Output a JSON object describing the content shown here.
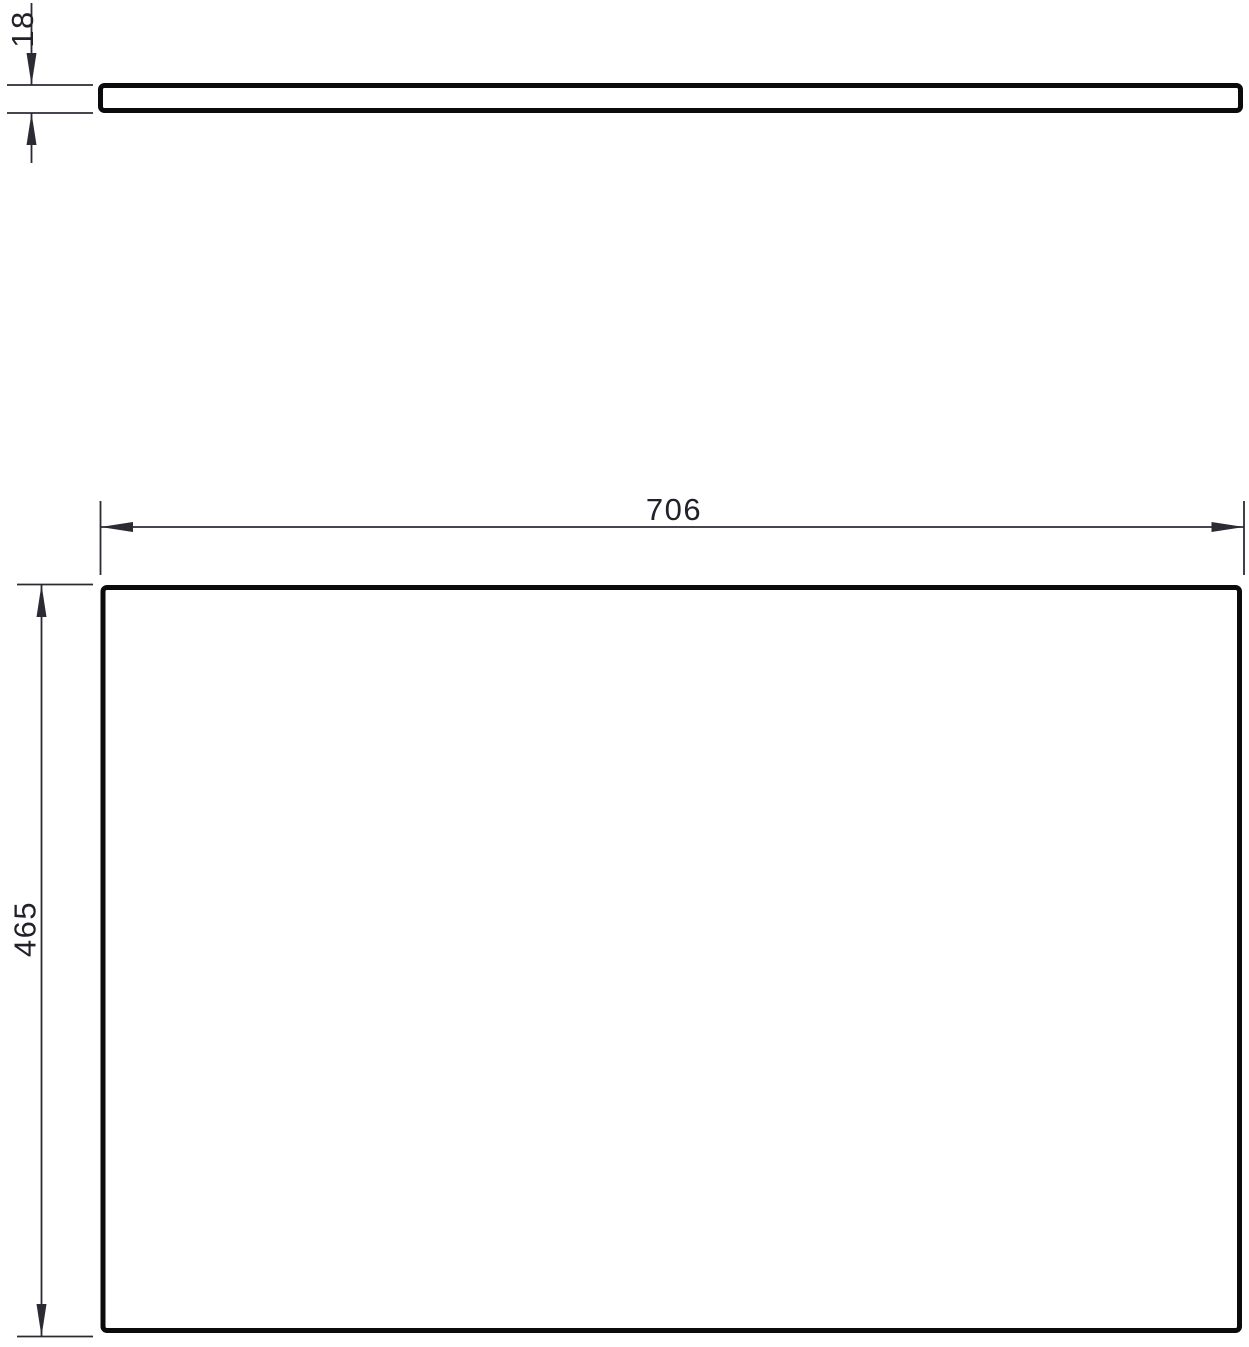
{
  "drawing": {
    "dimensions": {
      "thickness": {
        "label": "18",
        "orientation": "vertical"
      },
      "width": {
        "label": "706",
        "orientation": "horizontal"
      },
      "height": {
        "label": "465",
        "orientation": "vertical"
      }
    },
    "colors": {
      "part_outline": "#0b0b0d",
      "dimension_line": "#2b2b34",
      "label_text": "#21212b",
      "background": "#ffffff"
    }
  }
}
